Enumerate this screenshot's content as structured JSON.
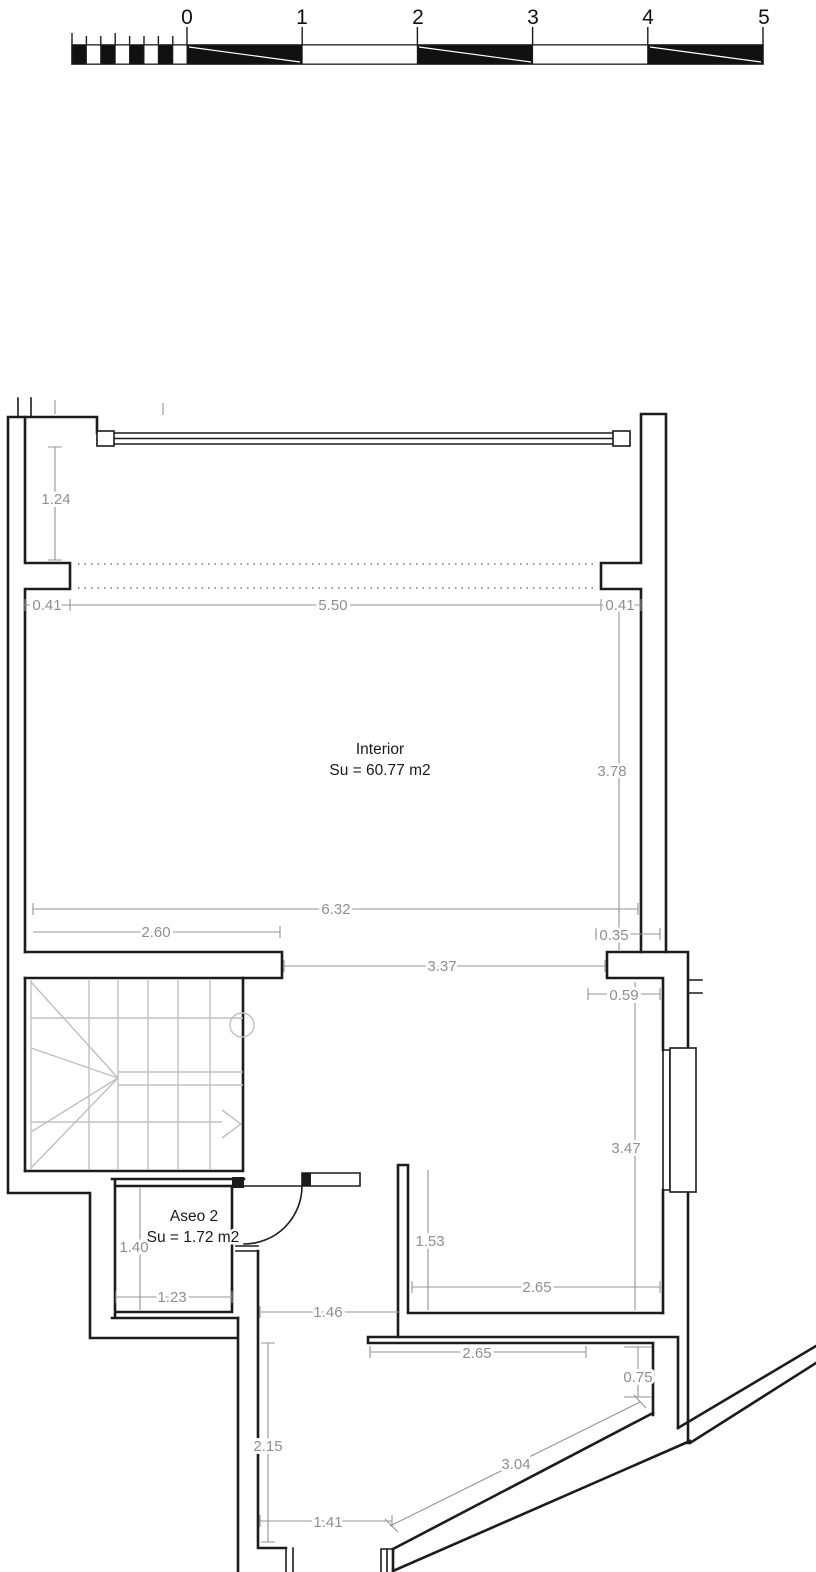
{
  "drawing_type": "floor-plan",
  "scale_bar": {
    "unit_labels": [
      "0",
      "1",
      "2",
      "3",
      "4",
      "5"
    ]
  },
  "rooms": {
    "interior": {
      "name": "Interior",
      "area": "Su = 60.77 m2"
    },
    "aseo": {
      "name": "Aseo 2",
      "area": "Su = 1.72 m2"
    }
  },
  "dimensions": [
    "1.24",
    "0.41",
    "5.50",
    "0.41",
    "3.78",
    "6.32",
    "2.60",
    "0.35",
    "3.37",
    "0.59",
    "3.47",
    "1.53",
    "1.40",
    "2.65",
    "1.23",
    "1.46",
    "2.65",
    "0.75",
    "2.15",
    "3.04",
    "1.41"
  ],
  "colors": {
    "wall": "#1c1c1c",
    "dimension": "#8f8f8f",
    "stair": "#c0c0c0",
    "background": "#ffffff"
  }
}
